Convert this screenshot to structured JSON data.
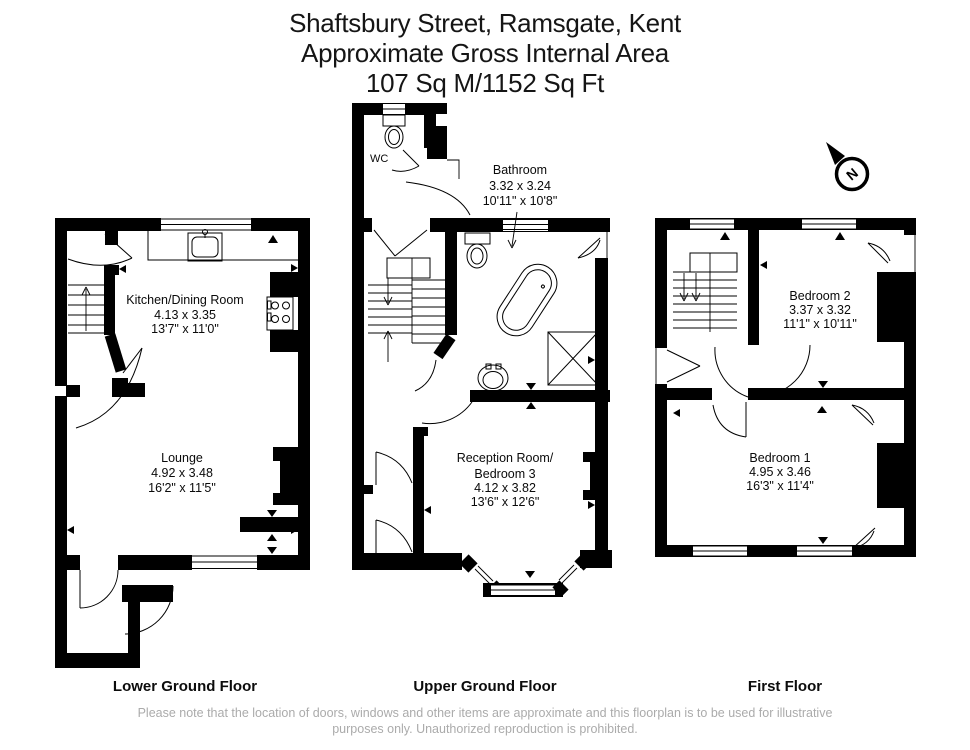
{
  "title": {
    "line1": "Shaftsbury Street, Ramsgate, Kent",
    "line2": "Approximate Gross Internal Area",
    "line3": "107 Sq M/1152 Sq Ft"
  },
  "compass": {
    "label": "N"
  },
  "floors": {
    "lower_ground": {
      "label": "Lower Ground Floor",
      "kitchen": {
        "name": "Kitchen/Dining Room",
        "metric": "4.13 x 3.35",
        "imperial": "13'7\" x 11'0\""
      },
      "lounge": {
        "name": "Lounge",
        "metric": "4.92 x 3.48",
        "imperial": "16'2\" x 11'5\""
      }
    },
    "upper_ground": {
      "label": "Upper Ground Floor",
      "wc": {
        "name": "WC"
      },
      "bathroom": {
        "name": "Bathroom",
        "metric": "3.32 x 3.24",
        "imperial": "10'11\" x 10'8\""
      },
      "reception": {
        "name_line1": "Reception Room/",
        "name_line2": "Bedroom 3",
        "metric": "4.12 x 3.82",
        "imperial": "13'6\" x 12'6\""
      }
    },
    "first": {
      "label": "First Floor",
      "bedroom2": {
        "name": "Bedroom 2",
        "metric": "3.37 x 3.32",
        "imperial": "11'1\" x 10'11\""
      },
      "bedroom1": {
        "name": "Bedroom 1",
        "metric": "4.95 x 3.46",
        "imperial": "16'3\" x 11'4\""
      }
    }
  },
  "footer": {
    "line1": "Please note that the location of doors, windows and other items are approximate and this floorplan is to be used for illustrative",
    "line2": "purposes only. Unauthorized reproduction is prohibited."
  }
}
